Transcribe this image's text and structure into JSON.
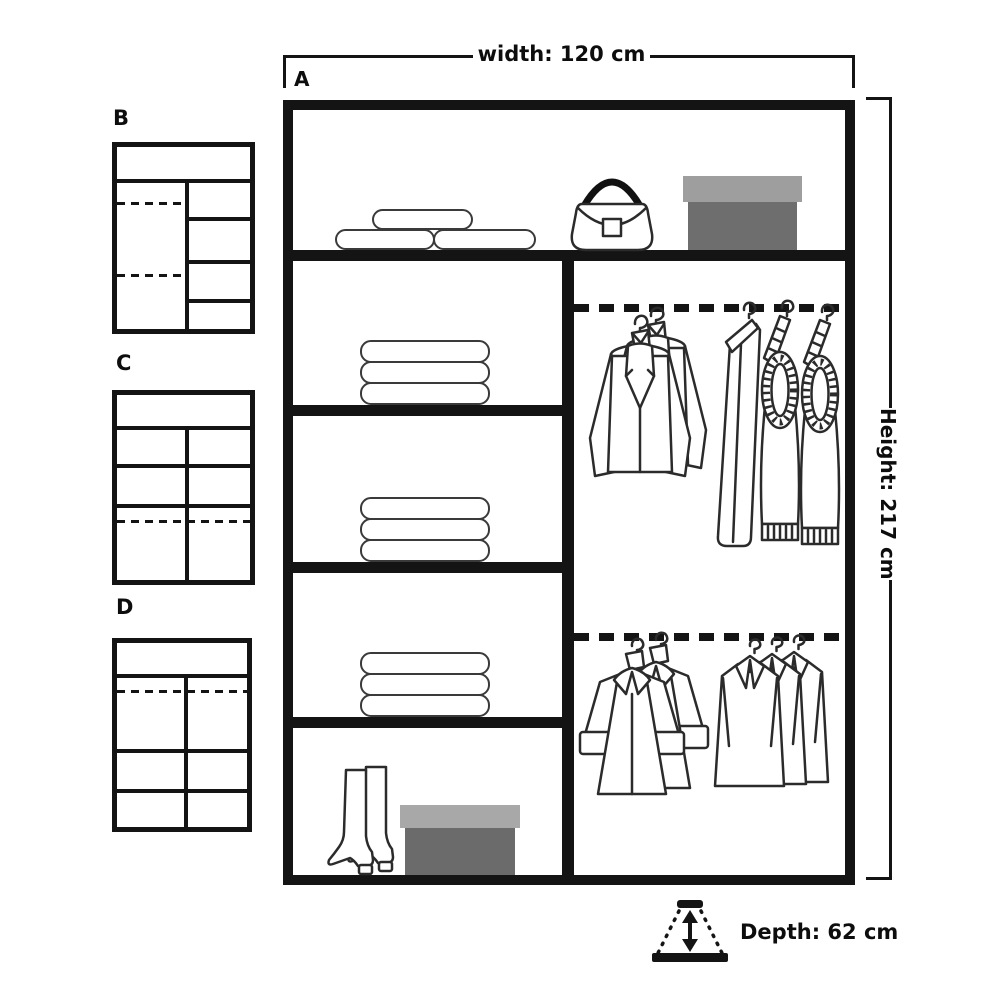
{
  "layouts": {
    "main": {
      "label": "A"
    },
    "alternatives": [
      {
        "label": "B"
      },
      {
        "label": "C"
      },
      {
        "label": "D"
      }
    ]
  },
  "dimensions": {
    "width_label": "width: 120 cm",
    "height_label": "Height: 217 cm",
    "depth_label": "Depth: 62 cm"
  },
  "contents": {
    "top_shelf": [
      "folded-duvets",
      "handbag",
      "storage-box"
    ],
    "left_shelves": [
      "folded-clothes-stack",
      "folded-clothes-stack",
      "folded-clothes-stack"
    ],
    "bottom_compartment": [
      "boots",
      "shoe-box"
    ],
    "upper_rail": [
      "suit-jackets",
      "trousers",
      "sweaters"
    ],
    "lower_rail": [
      "coats",
      "shirts"
    ]
  },
  "colors": {
    "line": "#141414",
    "storage_box_lid": "#9e9e9e",
    "storage_box_body": "#6e6e6e",
    "shoe_box_lid": "#a8a8a8",
    "shoe_box_body": "#6b6b6b"
  }
}
